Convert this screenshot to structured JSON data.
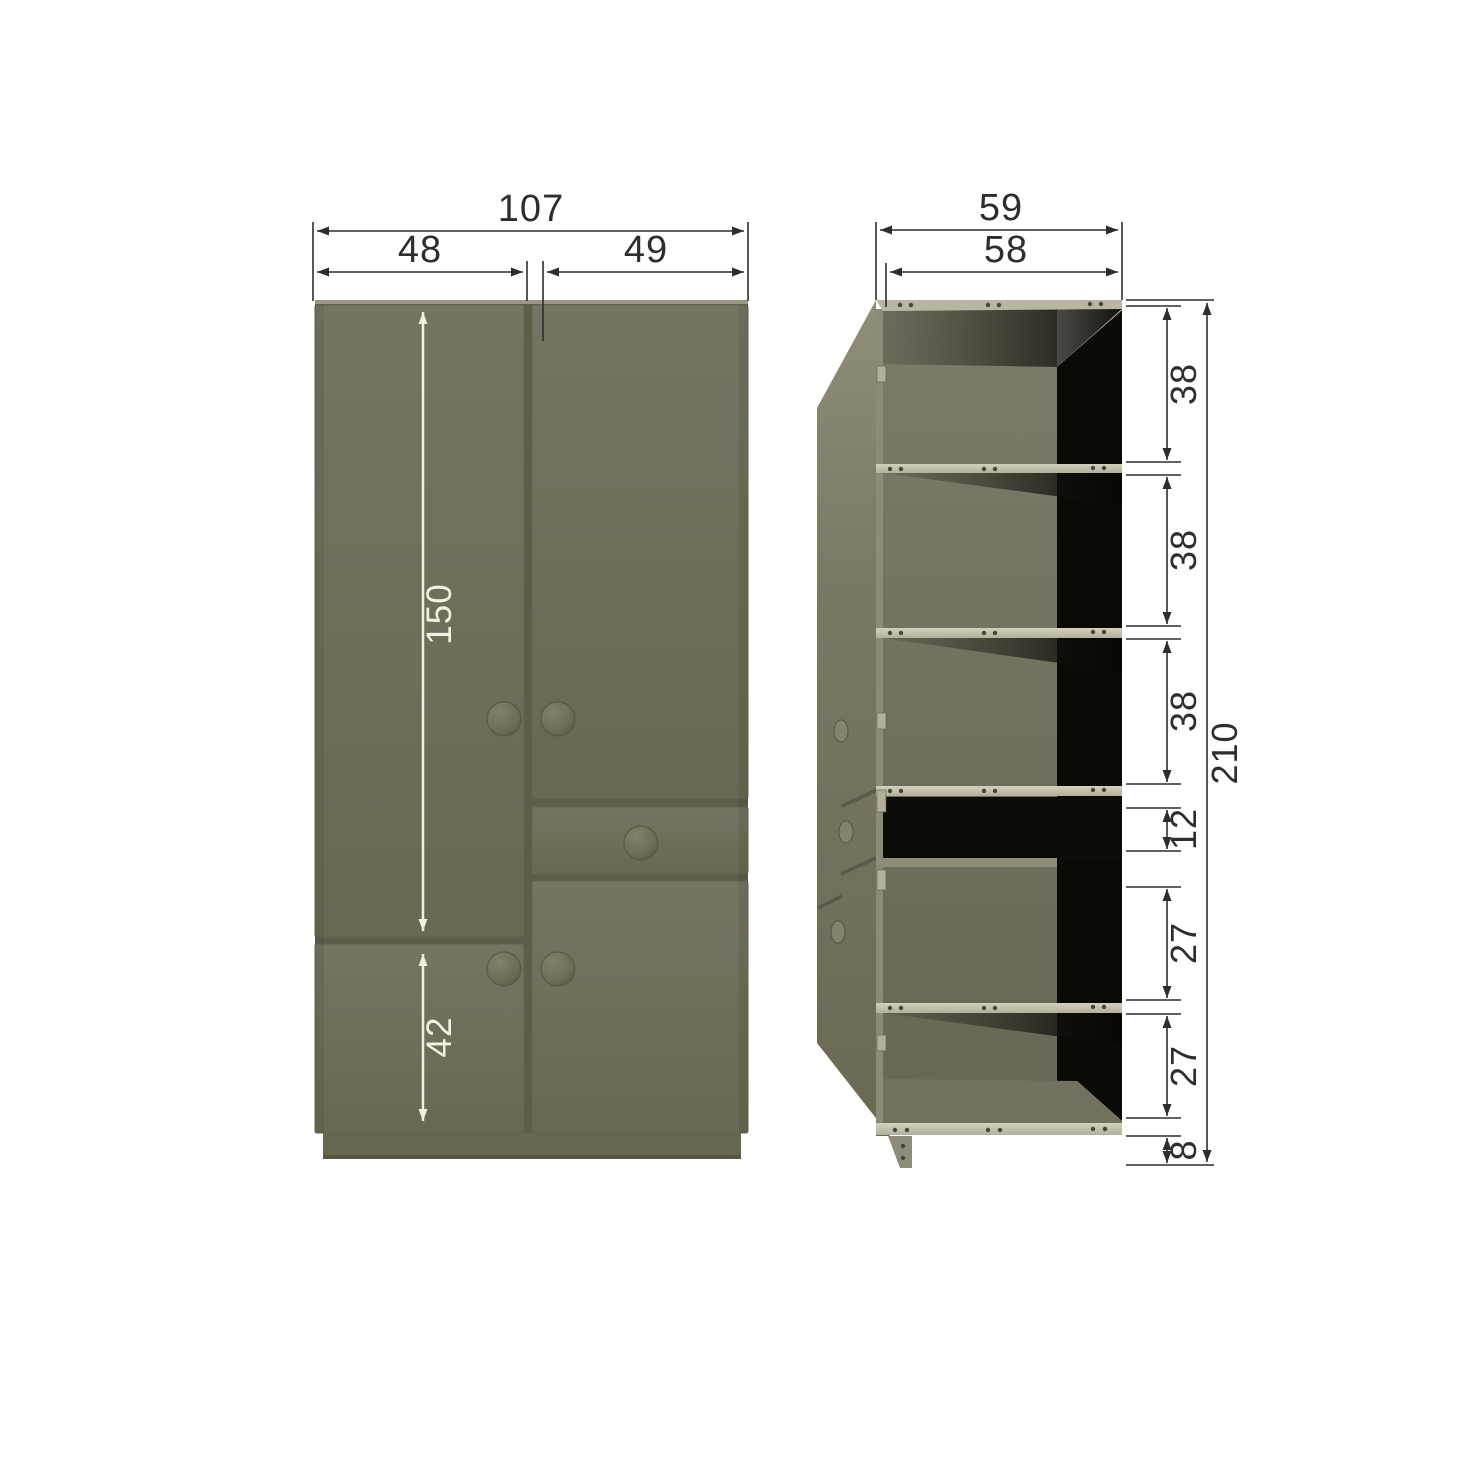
{
  "front_view": {
    "total_width": "107",
    "left_door_width": "48",
    "right_door_width": "49",
    "upper_door_height": "150",
    "lower_door_height": "42"
  },
  "side_view": {
    "total_depth": "59",
    "interior_depth": "58",
    "total_height": "210",
    "section_heights": [
      "38",
      "38",
      "38",
      "12",
      "27",
      "27",
      "8"
    ]
  },
  "colors": {
    "cabinet_olive": "#6f6e59",
    "cabinet_gap": "#5e5d4a",
    "shelf_edge": "#c6c3b0",
    "interior_back": "#75725f",
    "shadow_black": "#0a0a07",
    "dimension_dark": "#2d2d2d",
    "dimension_light": "#f3f0e3",
    "background": "#ffffff"
  }
}
